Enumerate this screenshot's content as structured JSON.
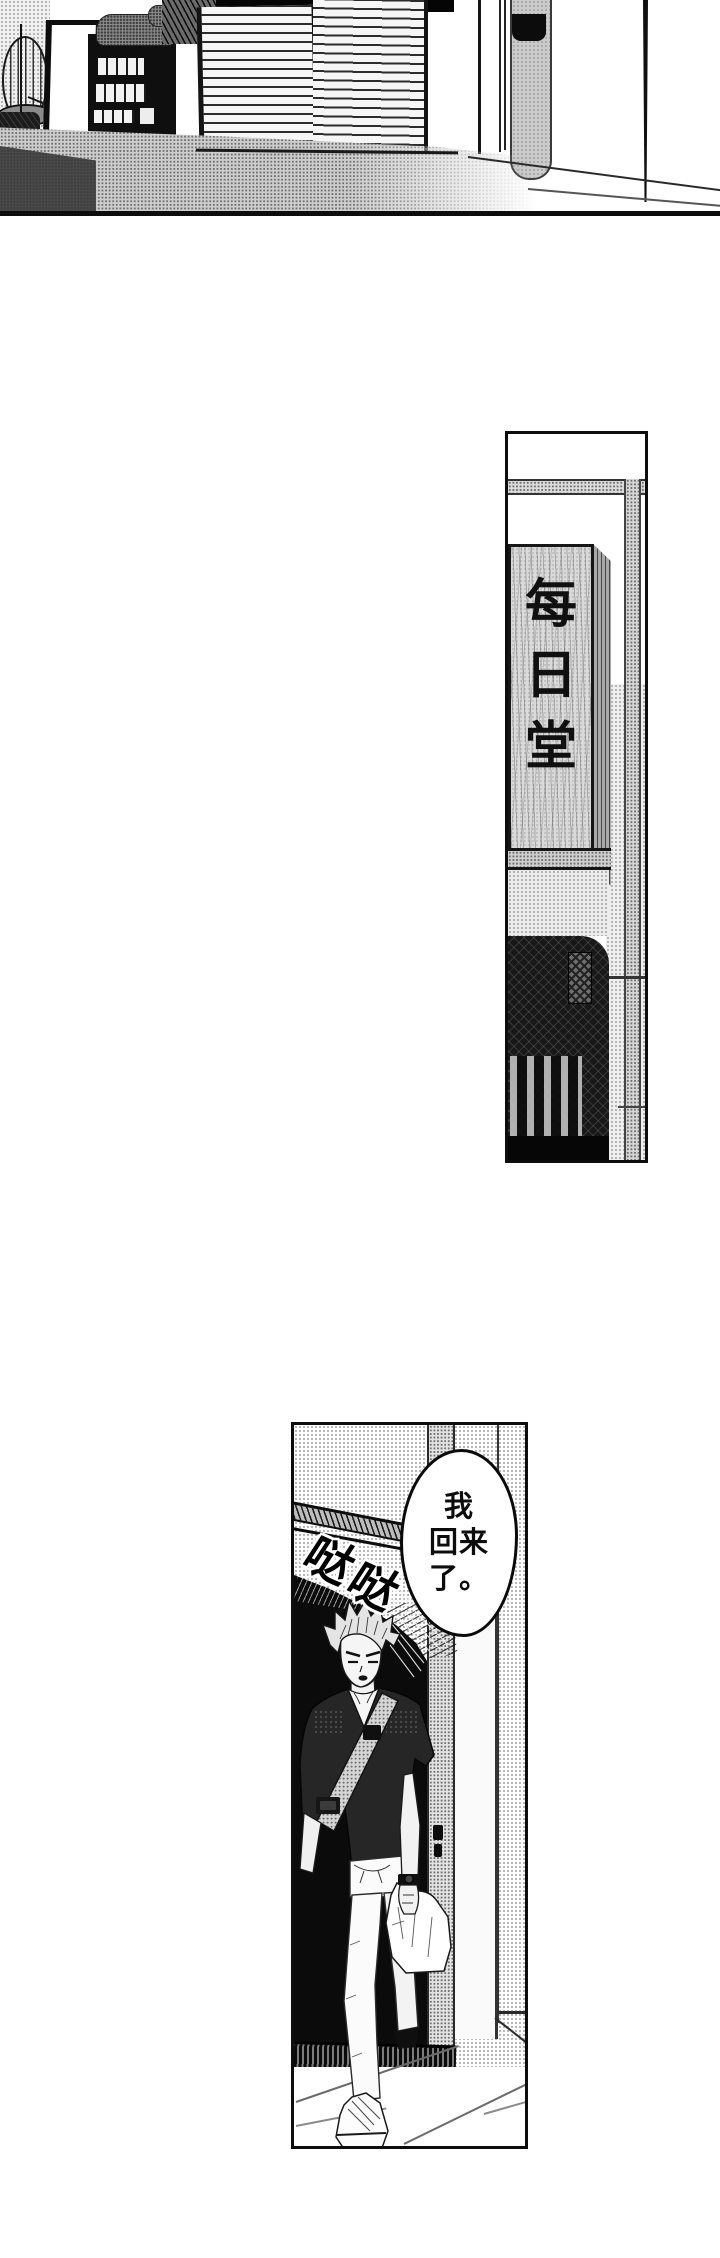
{
  "page": {
    "kind": "manga-page",
    "width": 720,
    "height": 2258
  },
  "colors": {
    "paper": "#ffffff",
    "ink": "#0d0d0d",
    "halftone_gray": "#9a9a9a",
    "wood_gray": "#dadada",
    "shirt_dark": "#262626"
  },
  "panels": {
    "street": {
      "description_name": "street-scene"
    },
    "signboard": {
      "text": "每日堂",
      "chars": [
        "每",
        "日",
        "堂"
      ]
    },
    "entryway": {
      "bubble": {
        "text": "我回来了。",
        "lines": [
          "我",
          "回来",
          "了。"
        ]
      },
      "sfx": {
        "text": "哒哒",
        "chars": [
          "哒",
          "哒"
        ]
      }
    }
  }
}
